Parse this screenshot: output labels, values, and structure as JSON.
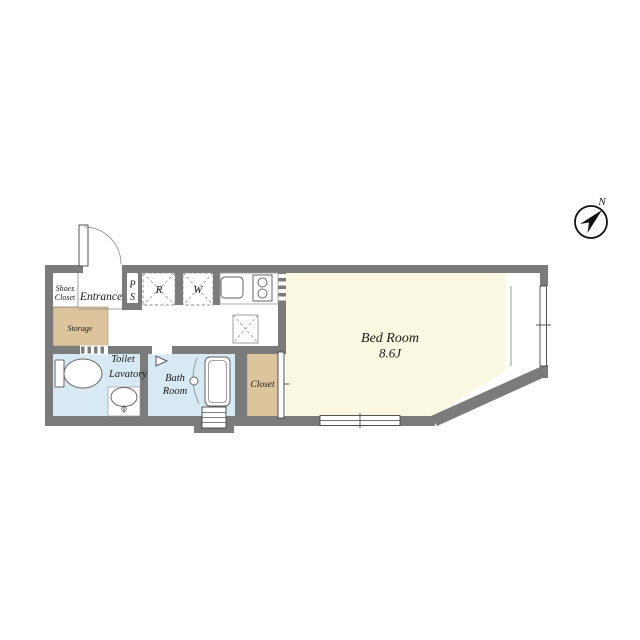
{
  "compass": {
    "north_label": "N"
  },
  "colors": {
    "wall": "#7b7b7b",
    "bedroom_fill": "#faf8e0",
    "storage_closet_fill": "#dcc49c",
    "wet_area_fill": "#d7e9f2",
    "text": "#1a1a1a"
  },
  "rooms": {
    "shoes_closet": {
      "label_line1": "Shoes",
      "label_line2": "Closet"
    },
    "entrance": {
      "label": "Entrance"
    },
    "storage": {
      "label": "Storage"
    },
    "pipe_space": {
      "label_line1": "P",
      "label_line2": "S"
    },
    "refrigerator_space": {
      "label": "R"
    },
    "washer_space": {
      "label": "W"
    },
    "toilet_lavatory": {
      "label_line1": "Toilet",
      "label_line2": "Lavatory"
    },
    "bath_room": {
      "label_line1": "Bath",
      "label_line2": "Room"
    },
    "closet": {
      "label": "Closet"
    },
    "bed_room": {
      "label": "Bed Room",
      "size": "8.6J"
    }
  }
}
